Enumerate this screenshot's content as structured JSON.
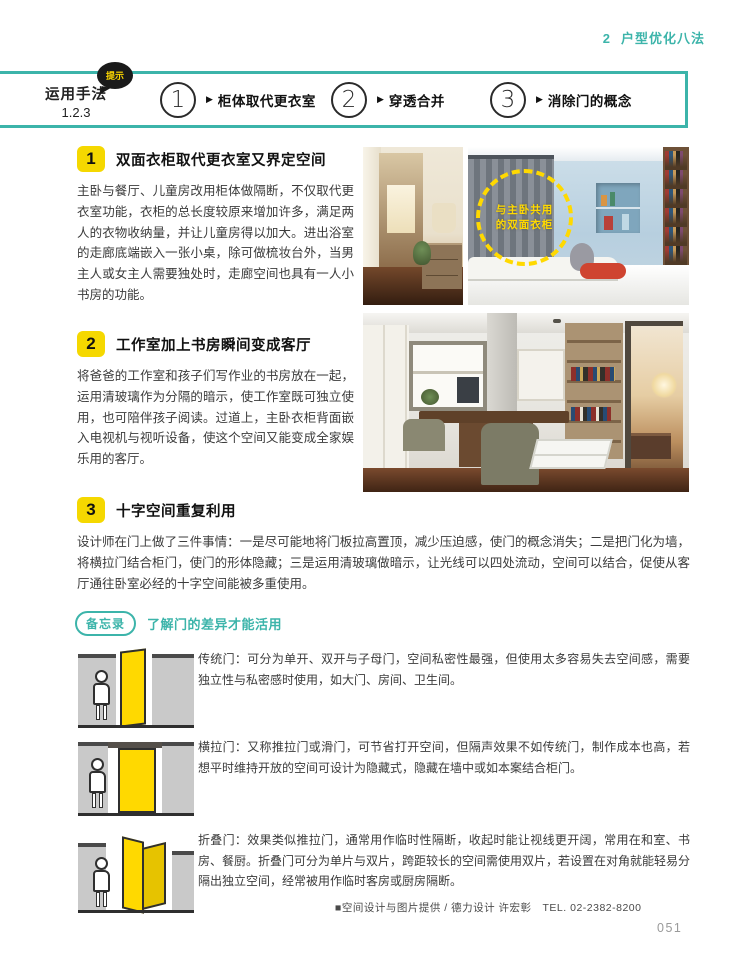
{
  "page": {
    "chapter_number": "2",
    "chapter_title": "户型优化八法",
    "page_number": "051",
    "credit": "■空间设计与图片提供 / 德力设计 许宏彰　TEL. 02-2382-8200"
  },
  "colors": {
    "teal": "#3cb4aa",
    "badge_yellow": "#f5d800",
    "door_yellow": "#ffd900"
  },
  "method_band": {
    "bubble_label": "提示",
    "title_line1": "运用手法",
    "title_line2": "1.2.3",
    "arrow": "▶",
    "items": [
      {
        "num": "1",
        "label": "柜体取代更衣室"
      },
      {
        "num": "2",
        "label": "穿透合并"
      },
      {
        "num": "3",
        "label": "消除门的概念"
      }
    ]
  },
  "sections": [
    {
      "num": "1",
      "title": "双面衣柜取代更衣室又界定空间",
      "body": "主卧与餐厅、儿童房改用柜体做隔断，不仅取代更衣室功能，衣柜的总长度较原来增加许多，满足两人的衣物收纳量，并让儿童房得以加大。进出浴室的走廊底端嵌入一张小桌，除可做梳妆台外，当男主人或女主人需要独处时，走廊空间也具有一人小书房的功能。"
    },
    {
      "num": "2",
      "title": "工作室加上书房瞬间变成客厅",
      "body": "将爸爸的工作室和孩子们写作业的书房放在一起，运用清玻璃作为分隔的暗示，使工作室既可独立使用，也可陪伴孩子阅读。过道上，主卧衣柜背面嵌入电视机与视听设备，使这个空间又能变成全家娱乐用的客厅。"
    },
    {
      "num": "3",
      "title": "十字空间重复利用",
      "body": "设计师在门上做了三件事情：一是尽可能地将门板拉高置顶，减少压迫感，使门的概念消失；二是把门化为墙，将横拉门结合柜门，使门的形体隐藏；三是运用清玻璃做暗示，让光线可以四处流动，空间可以结合，促使从客厅通往卧室必经的十字空间能被多重使用。"
    }
  ],
  "photo_annotation": {
    "line1": "与主卧共用",
    "line2": "的双面衣柜"
  },
  "memo": {
    "badge": "备忘录",
    "title": "了解门的差异才能活用",
    "items": [
      {
        "term": "传统门：",
        "desc": "可分为单开、双开与子母门，空间私密性最强，但使用太多容易失去空间感，需要独立性与私密感时使用，如大门、房间、卫生间。",
        "illustration": "swing-door"
      },
      {
        "term": "横拉门：",
        "desc": "又称推拉门或滑门，可节省打开空间，但隔声效果不如传统门，制作成本也高，若想平时维持开放的空间可设计为隐藏式，隐藏在墙中或如本案结合柜门。",
        "illustration": "sliding-door"
      },
      {
        "term": "折叠门：",
        "desc": "效果类似推拉门，通常用作临时性隔断，收起时能让视线更开阔，常用在和室、书房、餐厨。折叠门可分为单片与双片，跨距较长的空间需使用双片，若设置在对角就能轻易分隔出独立空间，经常被用作临时客房或厨房隔断。",
        "illustration": "folding-door"
      }
    ]
  }
}
